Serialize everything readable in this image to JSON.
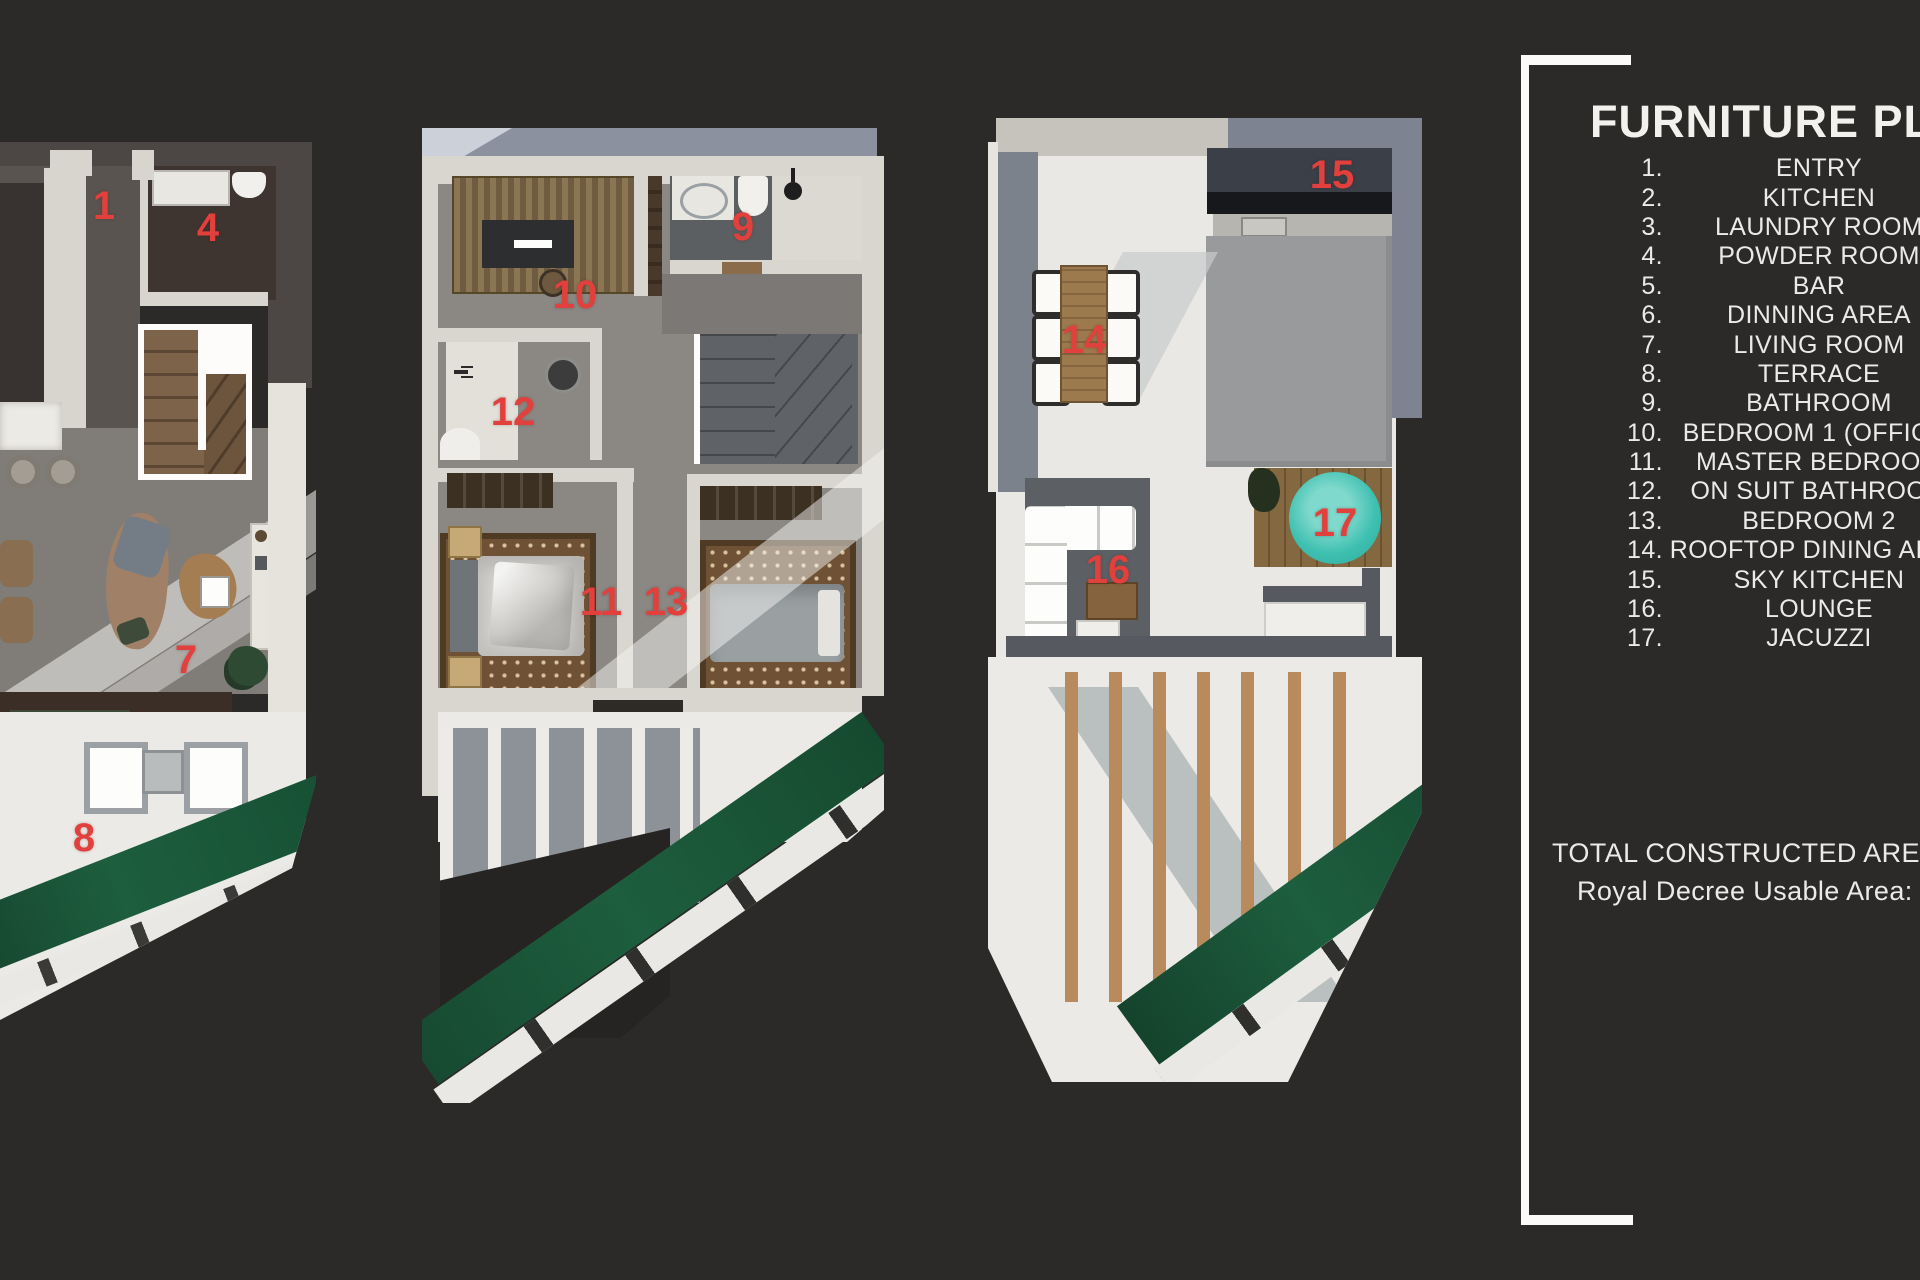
{
  "panel": {
    "title": "FURNITURE PLAN",
    "items": [
      {
        "num": "1.",
        "label": "ENTRY"
      },
      {
        "num": "2.",
        "label": "KITCHEN"
      },
      {
        "num": "3.",
        "label": "LAUNDRY ROOM"
      },
      {
        "num": "4.",
        "label": "POWDER ROOM"
      },
      {
        "num": "5.",
        "label": "BAR"
      },
      {
        "num": "6.",
        "label": "DINNING AREA"
      },
      {
        "num": "7.",
        "label": "LIVING ROOM"
      },
      {
        "num": "8.",
        "label": "TERRACE"
      },
      {
        "num": "9.",
        "label": "BATHROOM"
      },
      {
        "num": "10.",
        "label": "BEDROOM 1 (OFFICE)"
      },
      {
        "num": "11.",
        "label": "MASTER BEDROOM"
      },
      {
        "num": "12.",
        "label": "ON SUIT BATHROOM"
      },
      {
        "num": "13.",
        "label": "BEDROOM 2"
      },
      {
        "num": "14.",
        "label": "ROOFTOP DINING AREA"
      },
      {
        "num": "15.",
        "label": "SKY KITCHEN"
      },
      {
        "num": "16.",
        "label": "LOUNGE"
      },
      {
        "num": "17.",
        "label": "JACUZZI"
      }
    ],
    "footer": {
      "line1": "TOTAL CONSTRUCTED AREA: 1",
      "line2": "Royal Decree Usable Area: 9"
    }
  },
  "plans": {
    "ground_floor": {
      "markers": {
        "entry": "1",
        "powder_room": "4",
        "living_room": "7",
        "terrace": "8"
      }
    },
    "first_floor": {
      "markers": {
        "bathroom": "9",
        "bedroom1_office": "10",
        "master_bedroom": "11",
        "on_suit_bathroom": "12",
        "bedroom2": "13"
      }
    },
    "rooftop": {
      "markers": {
        "rooftop_dining": "14",
        "sky_kitchen": "15",
        "lounge": "16",
        "jacuzzi": "17"
      }
    }
  },
  "colors": {
    "background": "#2b2a29",
    "marker_red": "#e2403c",
    "jacuzzi_teal": "#3ec0b1",
    "lawn_green": "#1d5e3e",
    "panel_text": "#f2f1ee"
  }
}
